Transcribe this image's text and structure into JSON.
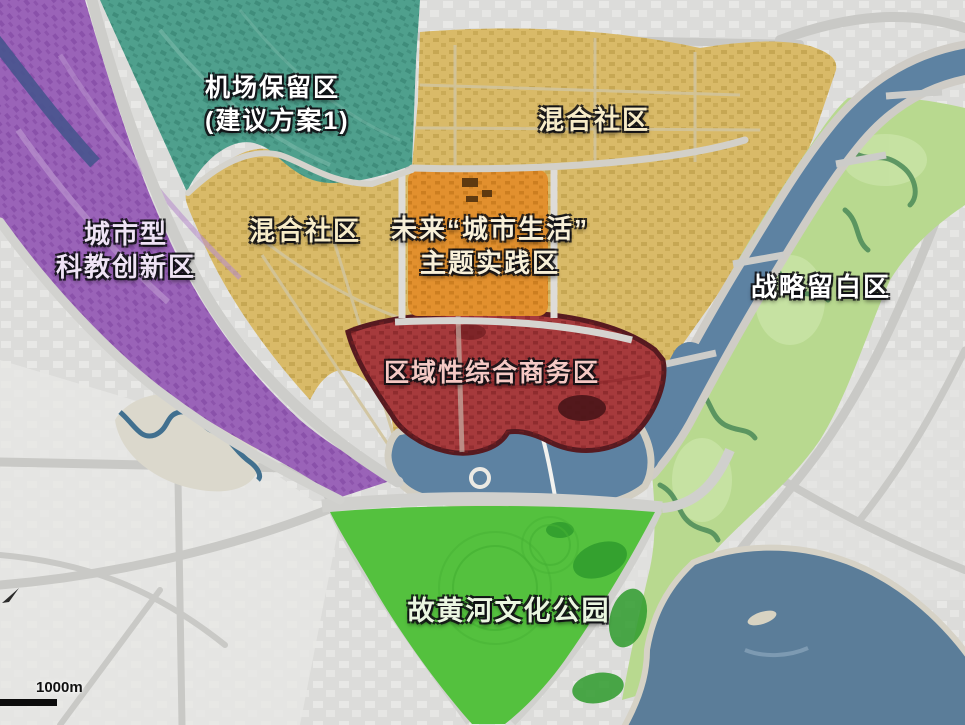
{
  "map": {
    "type": "urban-planning-zoning-map",
    "background_color": "#dcdcda",
    "road_color": "#c9c9c6"
  },
  "water": {
    "color": "#5d82a2",
    "lake_color": "#5b7d99",
    "creek_color": "#41708f"
  },
  "zones": [
    {
      "id": "airport-reserve",
      "line1": "机场保留区",
      "line2": "(建议方案1)",
      "color": "#4fa08d",
      "label_color": "#ffffff"
    },
    {
      "id": "mixed-community",
      "label": "混合社区",
      "color": "#d9ba68",
      "label_color": "#f7ecc8"
    },
    {
      "id": "mixed-community-left",
      "label": "混合社区",
      "color": "#d9ba68",
      "label_color": "#f7ecc8"
    },
    {
      "id": "future-city-life",
      "line1": "未来“城市生活”",
      "line2": "主题实践区",
      "color": "#e2902e",
      "label_color": "#f8f0d8"
    },
    {
      "id": "sci-edu-innovation",
      "line1": "城市型",
      "line2": "科教创新区",
      "color": "#9a63b8",
      "label_color": "#efe3f5"
    },
    {
      "id": "regional-business",
      "label": "区域性综合商务区",
      "color": "#a63a3c",
      "label_color": "#f5c9c4"
    },
    {
      "id": "strategic-reserve",
      "label": "战略留白区",
      "color": "#b8d98f",
      "label_color": "#ffffff"
    },
    {
      "id": "yellow-river-park",
      "label": "故黄河文化公园",
      "color": "#54c13e",
      "label_color": "#eaf6e0"
    }
  ],
  "scale_bar": {
    "label": "1000m"
  }
}
